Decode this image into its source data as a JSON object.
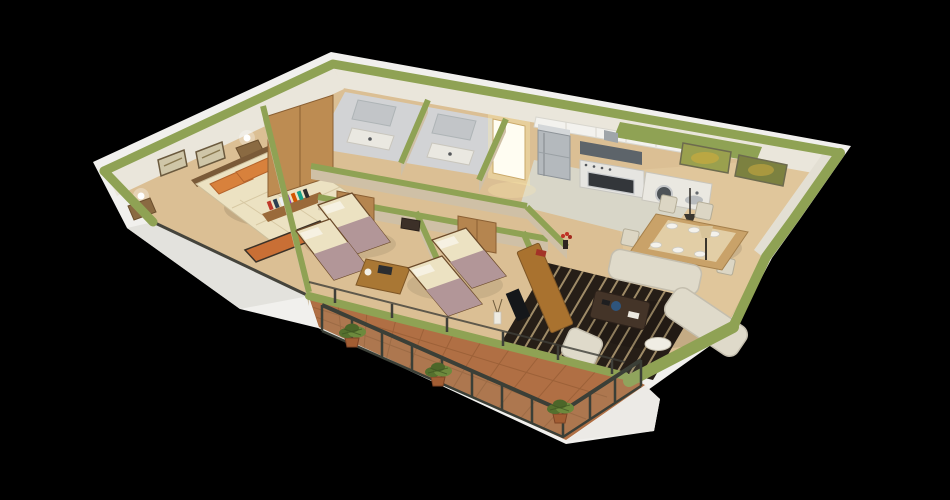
{
  "meta": {
    "kind": "3d-isometric-floor-plan-render",
    "background": "#000000",
    "view_label": "3D cutaway apartment floor plan"
  },
  "palette": {
    "bg": "#000000",
    "base": "#f1f0ed",
    "baseShade": "#e3e2dd",
    "wallTop": "#8fa254",
    "wallTopDeep": "#7e9147",
    "wallFace": "#eae6db",
    "partitionFace": "#cfc0a6",
    "woodFloor": "#dbbf94",
    "woodFloorLight": "#e7cfa4",
    "kitchenFloor": "#d8d6c8",
    "tileFloor": "#d2d3d5",
    "tileShade": "#c2c5c8",
    "terracotta": "#b06f44",
    "terracottaGrout": "#8d5630",
    "railMetal": "#3b3f37",
    "glassTint": "#9fb3a8",
    "plantGreen": "#55702e",
    "plantGreenLight": "#6d8a3d",
    "plantPot": "#a25d33",
    "wardrobeWood": "#bd8c52",
    "closetWood": "#b5854f",
    "deskWood": "#a97734",
    "consoleWood": "#a9722f",
    "bedSheet": "#ece2c2",
    "bedBlanket": "#b29698",
    "pillowOrange": "#d8813c",
    "benchOrange": "#c96f35",
    "headboardWood": "#7a5a38",
    "sofaCream": "#dfdaca",
    "sofaShade": "#c4beae",
    "rugDark": "#261e17",
    "rugStripe": "#c8b183",
    "coffeeTable": "#443428",
    "bowlBlue": "#2f557d",
    "applianceSteel": "#b4b9bd",
    "applianceDeep": "#8d9398",
    "hoodDark": "#5d646a",
    "ovenBlack": "#33363a",
    "counterWhite": "#eae8e1",
    "cabinetWhite": "#f3f2ee",
    "doorGlow": "#fffdf2",
    "doorGlowWarm": "#ffedad",
    "artOlive": "#9aa04e",
    "artOliveDeep": "#7c8140",
    "artAccent": "#c8a93f",
    "frameTan": "#cfc6a8",
    "frameEdge": "#6b5a3e",
    "tvBlack": "#15171a",
    "flowerRed": "#c03225",
    "darkFrame": "#45443c",
    "woodEdge": "#6b4a2a",
    "plateWhite": "#f4f2ec",
    "tableWood": "#c9a269",
    "runnerLight": "#e9d9b5",
    "lampGlow": "#ffffff"
  },
  "scene": {
    "style": "isometric cutaway, olive-green wall tops, white exterior shell on black background",
    "rooms": [
      {
        "id": "master-bedroom",
        "label": "Master bedroom",
        "furniture": [
          "double-bed",
          "orange-pillows",
          "foot-bench",
          "wardrobe",
          "two-nightstands",
          "two-wall-lamps",
          "two-picture-frames",
          "book-rack"
        ]
      },
      {
        "id": "bathroom-1",
        "label": "Bathroom 1",
        "fixtures": [
          "shower",
          "vanity-counter"
        ]
      },
      {
        "id": "bathroom-2",
        "label": "Bathroom 2",
        "fixtures": [
          "shower",
          "vanity-counter"
        ]
      },
      {
        "id": "entry-hall",
        "label": "Entry hall",
        "features": [
          "open-door-glowing-light"
        ]
      },
      {
        "id": "kitchen",
        "label": "Kitchen",
        "furniture": [
          "refrigerator",
          "range-hood",
          "stove-oven",
          "washing-machine",
          "sink-counter",
          "upper-cabinets"
        ]
      },
      {
        "id": "dining-area",
        "label": "Dining area",
        "furniture": [
          "dining-table",
          "chairs",
          "pendant-lamp",
          "green-artwork-left",
          "green-artwork-right"
        ]
      },
      {
        "id": "living-room",
        "label": "Living room",
        "furniture": [
          "sofa",
          "chaise-sofa",
          "armchair",
          "coffee-table",
          "striped-area-rug",
          "round-side-table",
          "tv-console",
          "floor-lamp"
        ]
      },
      {
        "id": "bedroom-2",
        "label": "Bedroom 2",
        "furniture": [
          "single-bed-a",
          "single-bed-b",
          "desk-with-laptop",
          "closet"
        ]
      },
      {
        "id": "bedroom-3",
        "label": "Bedroom 3",
        "furniture": [
          "single-bed-a",
          "single-bed-b",
          "closet",
          "bookshelf-console"
        ]
      },
      {
        "id": "balcony",
        "label": "Balcony terrace",
        "features": [
          "terracotta-tiles",
          "dark-metal-railing",
          "potted-plant-1",
          "potted-plant-2",
          "potted-plant-3"
        ]
      }
    ]
  }
}
